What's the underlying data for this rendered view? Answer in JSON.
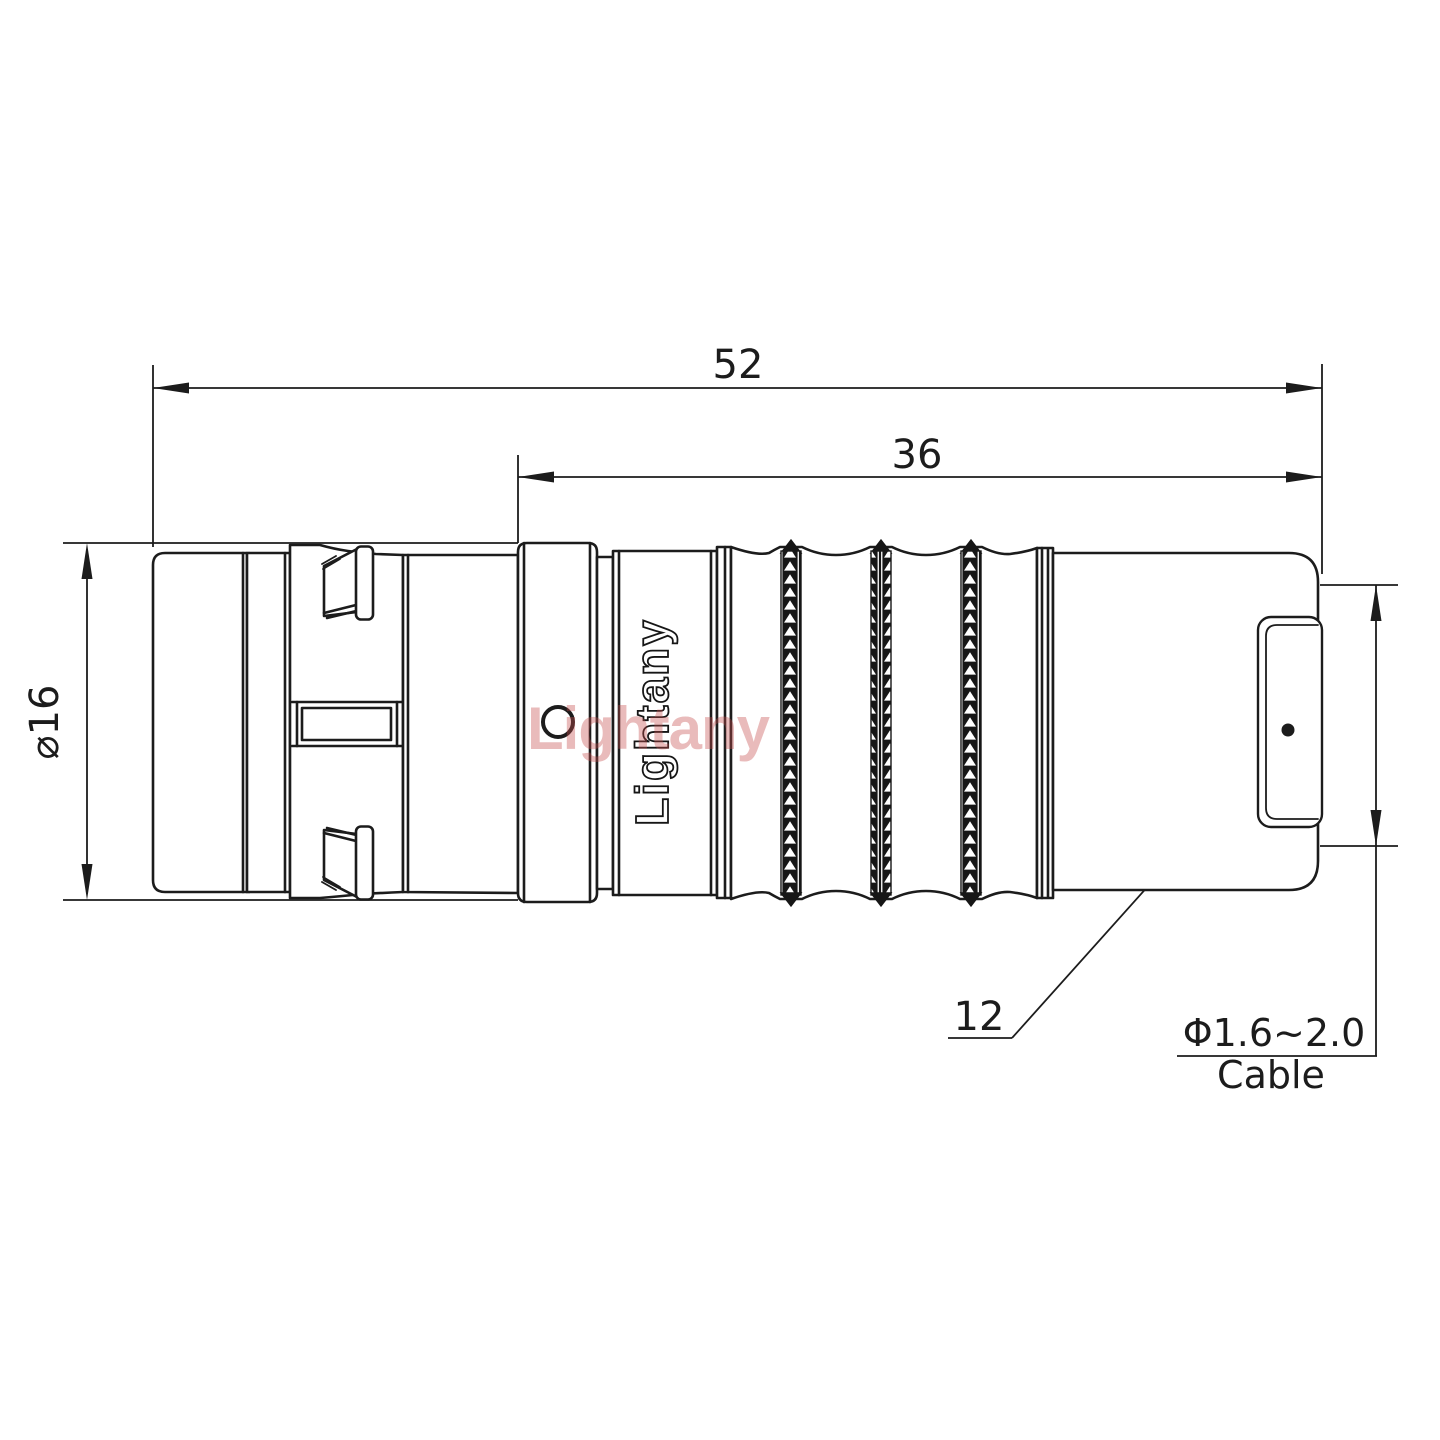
{
  "drawing": {
    "dimensions": {
      "overall_length": "52",
      "rear_length": "36",
      "front_diameter": "⌀16",
      "nut_size": "12",
      "cable_range": "Φ1.6~2.0",
      "cable_word": "Cable"
    },
    "brand": {
      "engraving": "Lightany",
      "watermark": "Lightany"
    },
    "colors": {
      "line": "#1c1c1c",
      "knurl_fill": "#161616",
      "watermark": "rgba(198,76,76,0.38)"
    }
  }
}
